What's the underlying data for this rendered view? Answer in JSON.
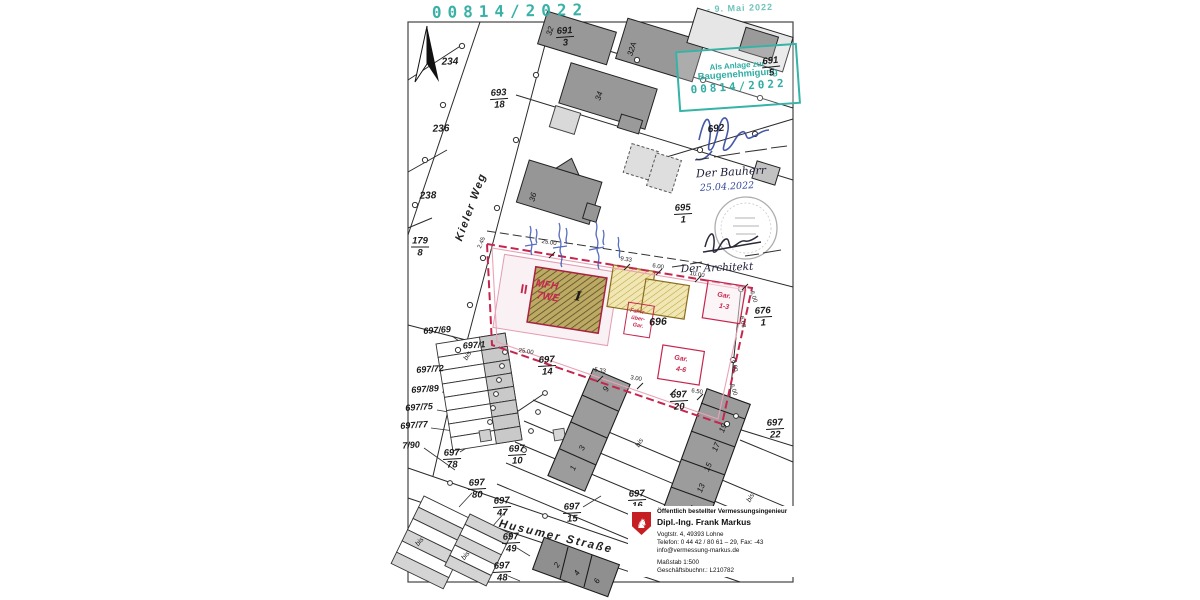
{
  "document": {
    "registry_stamp": "00814/2022",
    "date_stamp": "- 9. Mai 2022",
    "approval_stamp": {
      "line1": "Als Anlage zur",
      "line2": "Baugenehmigung",
      "number": "00814/2022"
    },
    "signatures": {
      "bauherr_label": "Der Bauherr",
      "bauherr_date": "25.04.2022",
      "architekt_label": "Der Architekt"
    }
  },
  "streets": {
    "kieler_weg": "Kieler Weg",
    "husumer_strasse": "Husumer Straße"
  },
  "plan": {
    "storeys": "II",
    "building_type": "MFH",
    "units": "7WE",
    "house_label": "I",
    "parcel_696": "696",
    "garage13": {
      "l1": "Gar.",
      "l2": "1-3"
    },
    "garage46": {
      "l1": "Gar.",
      "l2": "4-6"
    },
    "bike_shed": {
      "l1": "Fahrr-",
      "l2": "über-",
      "l3": "Gar."
    }
  },
  "parcels": {
    "p234": "234",
    "p236": "236",
    "p238": "238",
    "p692": "692",
    "bis": "bis",
    "refs": {
      "r69": "697/69",
      "r1": "697/1",
      "r72": "697/72",
      "r89": "697/89",
      "r75": "697/75",
      "r77": "697/77",
      "r90": "7/90"
    }
  },
  "fractions": {
    "f693_18": {
      "t": "693",
      "b": "18"
    },
    "f691_3": {
      "t": "691",
      "b": "3"
    },
    "f691_5": {
      "t": "691",
      "b": "5"
    },
    "f179_8": {
      "t": "179",
      "b": "8"
    },
    "f695_1": {
      "t": "695",
      "b": "1"
    },
    "f676_1": {
      "t": "676",
      "b": "1"
    },
    "f697_14": {
      "t": "697",
      "b": "14"
    },
    "f697_20": {
      "t": "697",
      "b": "20"
    },
    "f697_22": {
      "t": "697",
      "b": "22"
    },
    "f697_16": {
      "t": "697",
      "b": "16"
    },
    "f697_10": {
      "t": "697",
      "b": "10"
    },
    "f697_78": {
      "t": "697",
      "b": "78"
    },
    "f697_80": {
      "t": "697",
      "b": "80"
    },
    "f697_47": {
      "t": "697",
      "b": "47"
    },
    "f697_15": {
      "t": "697",
      "b": "15"
    },
    "f697_49": {
      "t": "697",
      "b": "49"
    },
    "f697_48": {
      "t": "697",
      "b": "48"
    }
  },
  "house_numbers": {
    "h32": "32",
    "h32a": "32A",
    "h34": "34",
    "h36": "36",
    "h1": "1",
    "h3": "3",
    "h9": "9",
    "h11": "11",
    "h13": "13",
    "h15": "15",
    "h17": "17",
    "h19": "19",
    "h2": "2",
    "h4": "4",
    "h6": "6"
  },
  "measurements": {
    "m25a": "25.00",
    "m25b": "25.00",
    "m933": "9.33",
    "m6a": "6.00",
    "m10": "10.00",
    "m6b": "6.00",
    "m533": "5.33",
    "m3": "3.00",
    "m65": "6.50",
    "m6c": "6.00",
    "m6d": "6.00",
    "m603": "6.03",
    "m245": "2.45"
  },
  "surveyor_box": {
    "title": "Öffentlich bestellter Vermessungsingenieur",
    "name": "Dipl.-Ing. Frank Markus",
    "address": "Vogtstr. 4, 49393 Lohne",
    "phone": "Telefon: 0 44 42 / 80 61 – 29, Fax: -43",
    "email": "info@vermessung-markus.de",
    "scale": "Maßstab 1:500",
    "book_no": "Geschäftsbuchnr.: L210782"
  },
  "colors": {
    "stamp_teal": "#2fada3",
    "plan_red": "#c6264e",
    "plan_pink": "#e9a3b6",
    "ink_blue": "#31479f",
    "hatch_dark": "#bca964",
    "hatch_yellow": "#f1e7b4"
  }
}
